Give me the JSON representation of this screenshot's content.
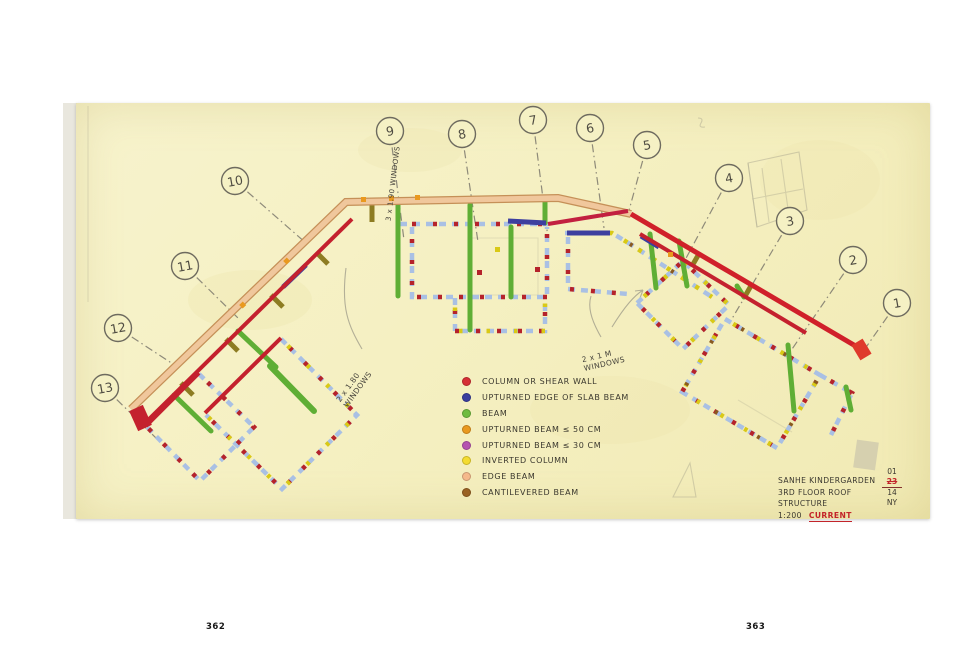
{
  "page_numbers": {
    "left": "362",
    "right": "363"
  },
  "legend": {
    "items": [
      {
        "label": "COLUMN OR SHEAR WALL",
        "color": "#d62f35"
      },
      {
        "label": "UPTURNED EDGE OF SLAB BEAM",
        "color": "#3a3e9e"
      },
      {
        "label": "BEAM",
        "color": "#6fbc3f"
      },
      {
        "label": "UPTURNED BEAM ≤ 50 CM",
        "color": "#e9991f"
      },
      {
        "label": "UPTURNED BEAM ≤ 30 CM",
        "color": "#b554b0"
      },
      {
        "label": "INVERTED COLUMN",
        "color": "#f4dc30"
      },
      {
        "label": "EDGE BEAM",
        "color": "#f5b98b"
      },
      {
        "label": "CANTILEVERED BEAM",
        "color": "#9a6223"
      }
    ]
  },
  "title_block": {
    "project": "SANHE KINDERGARDEN",
    "drawing": "3RD FLOOR ROOF STRUCTURE",
    "scale": "1:200",
    "status": "CURRENT",
    "stamp": {
      "line1": "01",
      "line2": "23",
      "line3": "14",
      "line4": "NY"
    }
  },
  "annotations": [
    {
      "id": "windows-top",
      "lines": [
        "3 x 1.90 WINDOWS"
      ]
    },
    {
      "id": "windows-left",
      "lines": [
        "2 x 1.80",
        "WINDOWS"
      ]
    },
    {
      "id": "windows-right",
      "lines": [
        "2 x 1 M",
        "WINDOWS"
      ]
    }
  ],
  "grid": {
    "bubbles": [
      {
        "n": "1",
        "cx": 897,
        "cy": 303,
        "lx": 862,
        "ly": 353
      },
      {
        "n": "2",
        "cx": 853,
        "cy": 260,
        "lx": 788,
        "ly": 355
      },
      {
        "n": "3",
        "cx": 790,
        "cy": 221,
        "lx": 730,
        "ly": 322
      },
      {
        "n": "4",
        "cx": 729,
        "cy": 178,
        "lx": 684,
        "ly": 262
      },
      {
        "n": "5",
        "cx": 647,
        "cy": 145,
        "lx": 628,
        "ly": 214
      },
      {
        "n": "6",
        "cx": 590,
        "cy": 128,
        "lx": 604,
        "ly": 228
      },
      {
        "n": "7",
        "cx": 533,
        "cy": 120,
        "lx": 548,
        "ly": 238
      },
      {
        "n": "8",
        "cx": 462,
        "cy": 134,
        "lx": 478,
        "ly": 242
      },
      {
        "n": "9",
        "cx": 390,
        "cy": 131,
        "lx": 404,
        "ly": 240
      },
      {
        "n": "10",
        "cx": 235,
        "cy": 181,
        "lx": 306,
        "ly": 243
      },
      {
        "n": "11",
        "cx": 185,
        "cy": 266,
        "lx": 240,
        "ly": 320
      },
      {
        "n": "12",
        "cx": 118,
        "cy": 328,
        "lx": 176,
        "ly": 366
      },
      {
        "n": "13",
        "cx": 105,
        "cy": 388,
        "lx": 158,
        "ly": 440
      }
    ]
  }
}
